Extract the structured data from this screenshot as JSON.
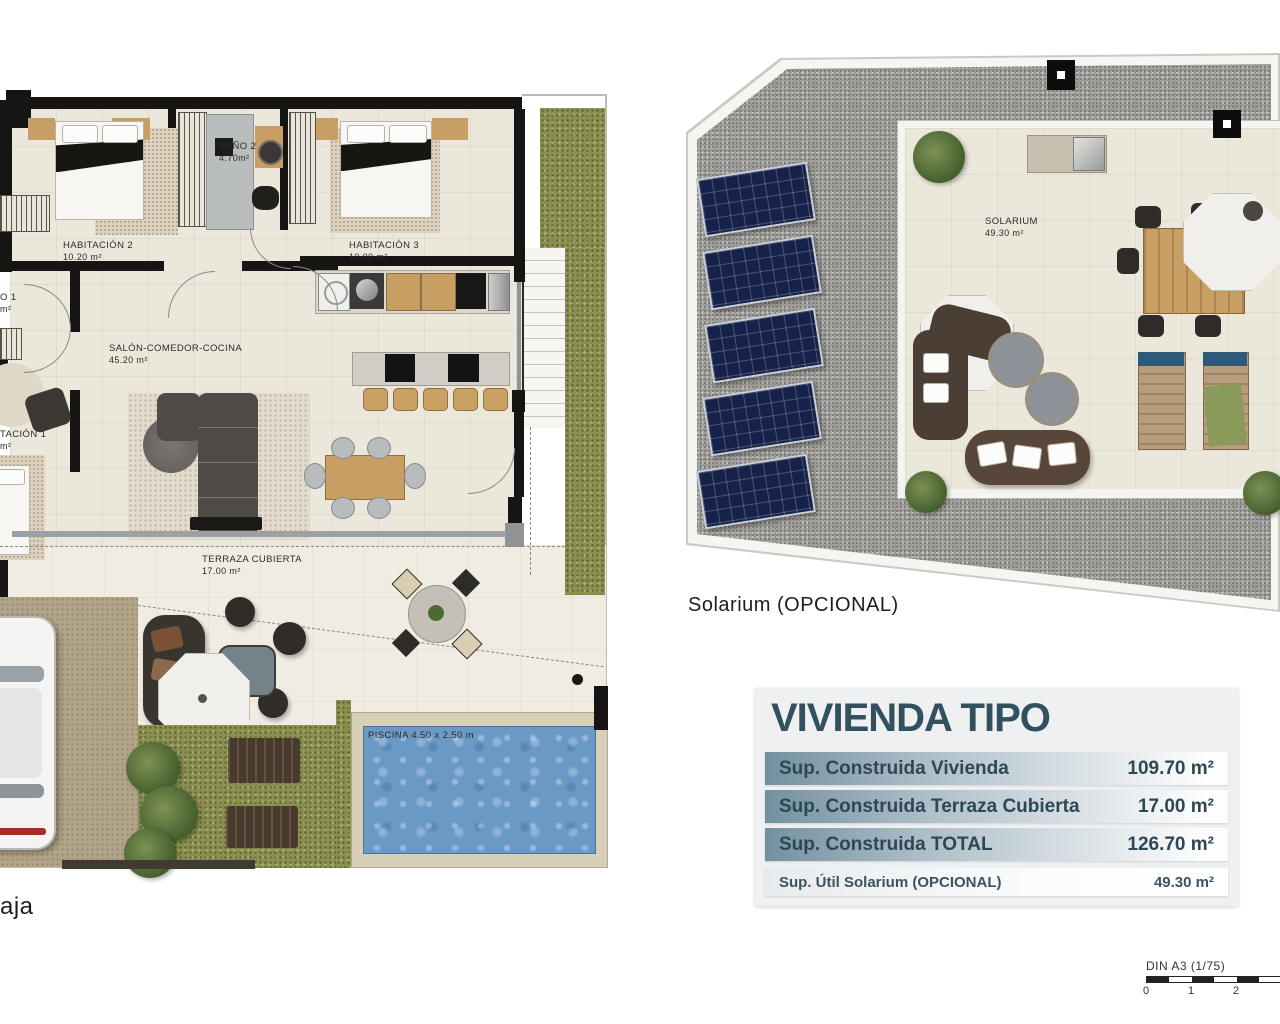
{
  "ground_floor": {
    "caption_fragment": "aja",
    "rooms": {
      "hab2": {
        "name": "HABITACIÓN 2",
        "area": "10.20 m²"
      },
      "bano2": {
        "name": "BAÑO 2",
        "area": "4.70m²"
      },
      "hab3": {
        "name": "HABITACIÓN 3",
        "area": "10.00 m²"
      },
      "salon": {
        "name": "SALÓN-COMEDOR-COCINA",
        "area": "45.20 m²"
      },
      "terraza": {
        "name": "TERRAZA CUBIERTA",
        "area": "17.00 m²"
      },
      "bano1_fragment": {
        "name": "O 1",
        "area": "m²"
      },
      "hab1_fragment": {
        "name": "TACIÓN 1",
        "area": "m²"
      }
    },
    "pool_label": "PISCINA 4.50 x 2.50 m"
  },
  "solarium_plan": {
    "caption": "Solarium (OPCIONAL)",
    "room": {
      "name": "SOLARIUM",
      "area": "49.30 m²"
    }
  },
  "summary_table": {
    "title": "VIVIENDA TIPO",
    "rows": [
      {
        "label": "Sup. Construida Vivienda",
        "value": "109.70 m²"
      },
      {
        "label": "Sup. Construida Terraza Cubierta",
        "value": "17.00 m²"
      },
      {
        "label": "Sup. Construida TOTAL",
        "value": "126.70 m²"
      }
    ],
    "optional_row": {
      "label": "Sup. Útil Solarium (OPCIONAL)",
      "value": "49.30 m²"
    }
  },
  "scale_bar": {
    "label": "DIN A3 (1/75)",
    "ticks": [
      "0",
      "1",
      "2"
    ]
  },
  "colors": {
    "title_text": "#33505f",
    "row_gradient_start": "#74909f",
    "wall": "#171513",
    "grass": "#8b8f4f",
    "pool_water": "#6b99c6",
    "gravel": "#a7a5a1",
    "solar_panel": "#17224a"
  }
}
